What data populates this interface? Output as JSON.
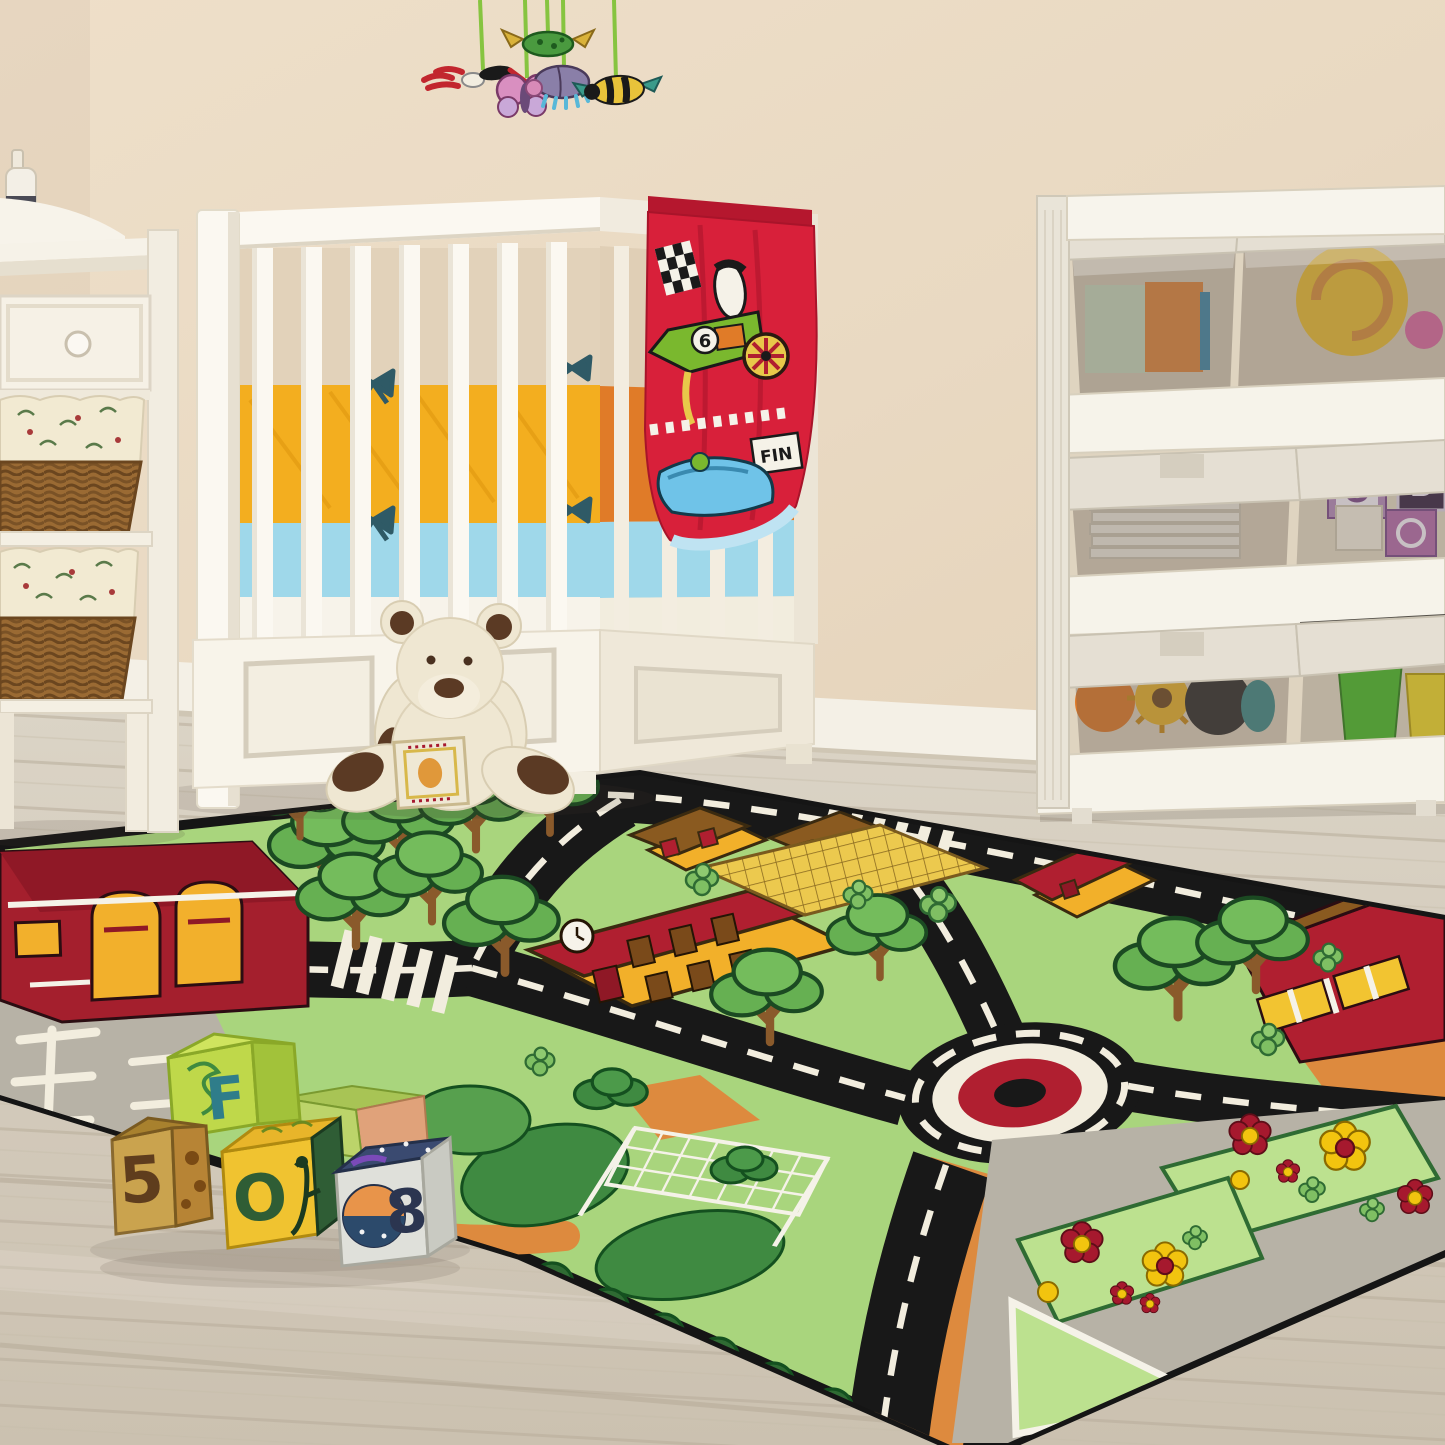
{
  "scene_type": "nursery room photograph with crib, toy shelf, changing table, teddy bear, fabric blocks and a city-road play rug",
  "palette": {
    "wall": "#eadcc6",
    "baseboard": "#f4f0e6",
    "floor_wood": "#d5ccbd",
    "rug_green": "#a9d57d",
    "road_black": "#181818",
    "road_dash_white": "#f2edde",
    "rug_orange": "#dd8a3e",
    "roof_red": "#b01f30",
    "building_yellow": "#f2b02a",
    "tree_green": "#66b052",
    "hedge_dark_green": "#3f8a41",
    "parking_gray": "#b7b2a6",
    "crib_white": "#faf6ee",
    "bumper_yellow": "#f3ae1f",
    "bumper_orange": "#e07b28",
    "sheet_blue": "#9fd8ea",
    "blanket_red": "#d8203a",
    "teddy_cream": "#efe7d2",
    "teddy_brown": "#5b3a24",
    "wicker_brown": "#9a6a33"
  },
  "mobile": {
    "toys": [
      "dragonfly",
      "butterfly",
      "beetle",
      "turtle",
      "bee"
    ]
  },
  "blanket": {
    "finish_flag_text": "FIN",
    "race_car_number": "6"
  },
  "floor_blocks": {
    "block_number_5": "5",
    "block_letter_f": "F",
    "block_letter_o": "O",
    "block_number_8": "8"
  },
  "shelf": {
    "bin_block_letter_o": "O",
    "bin_block_letter_b": "B"
  }
}
